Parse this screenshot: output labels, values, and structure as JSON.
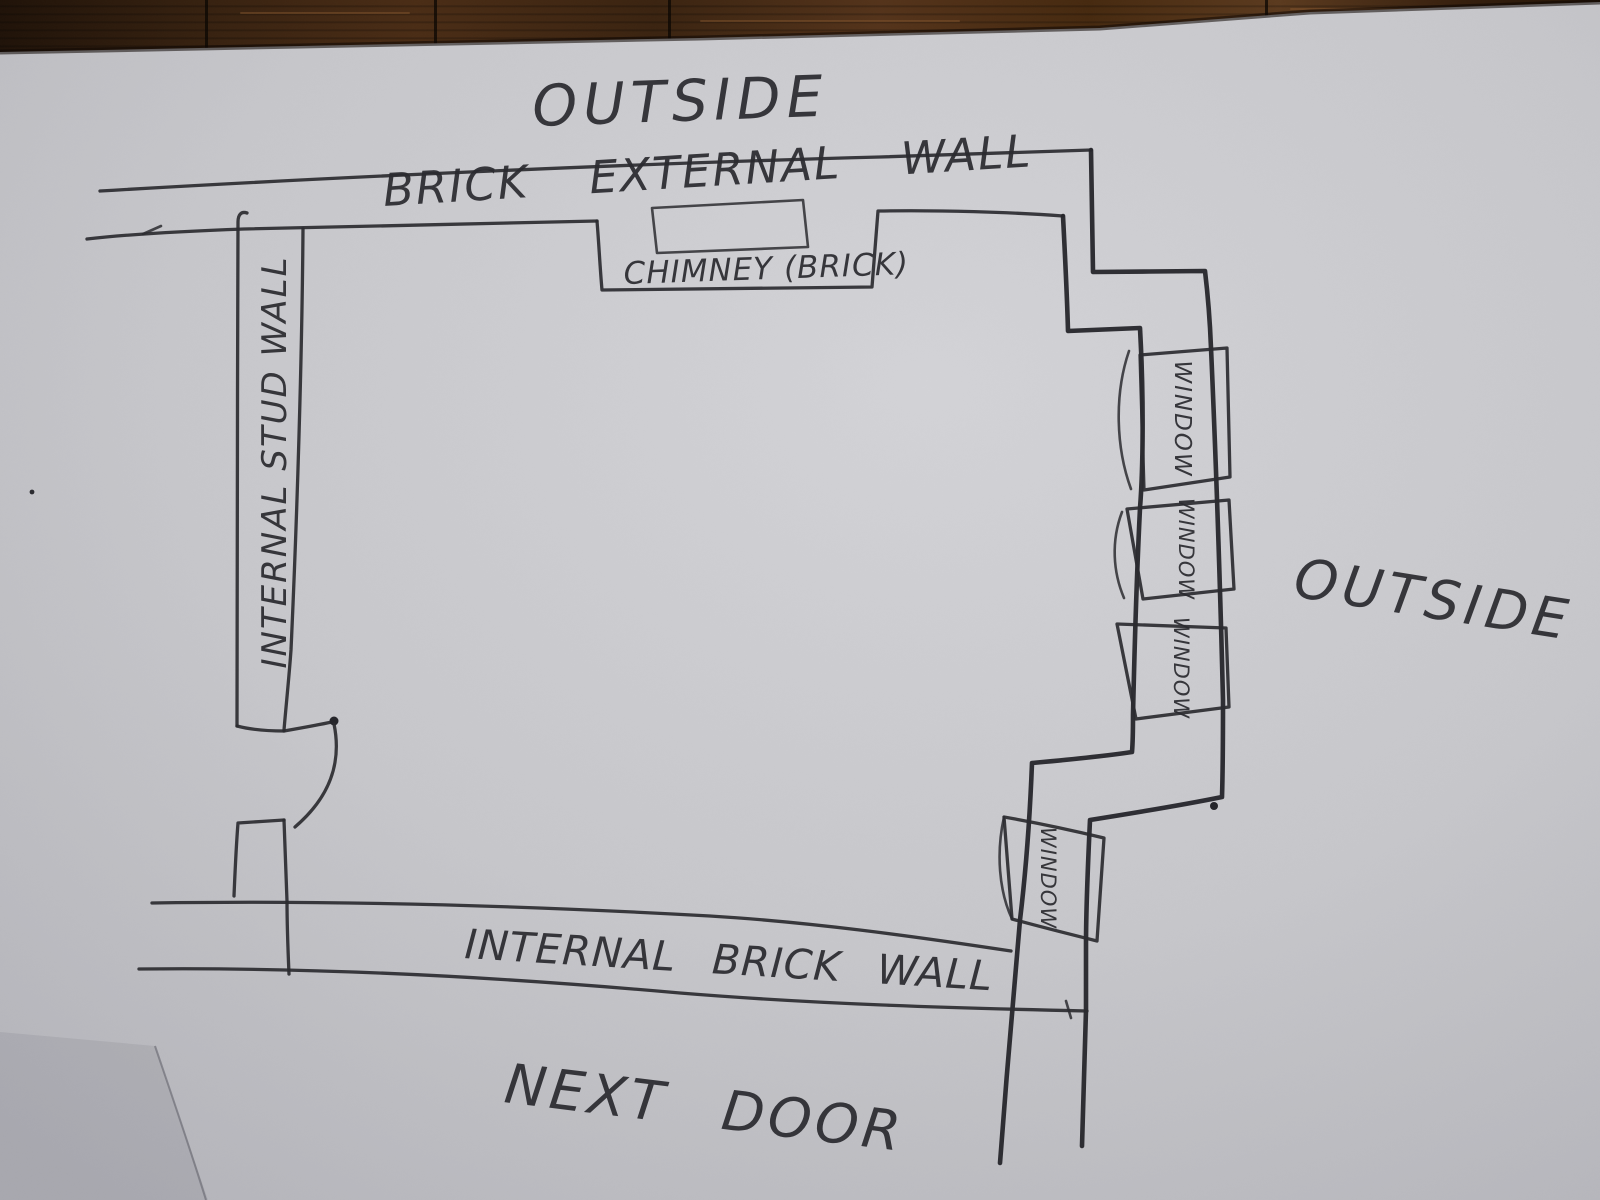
{
  "labels": {
    "outside_top": "OUTSIDE",
    "brick_external_wall": "BRICK EXTERNAL WALL",
    "chimney": "CHIMNEY (BRICK)",
    "internal_stud_wall": "INTERNAL STUD WALL",
    "outside_right": "OUTSIDE",
    "internal_brick_wall": "INTERNAL BRICK WALL",
    "next_door": "NEXT DOOR"
  },
  "windows": [
    {
      "label": "WINDOW"
    },
    {
      "label": "WINDOW"
    },
    {
      "label": "WINDOW"
    },
    {
      "label": "WINDOW"
    }
  ],
  "colors": {
    "ink": "#2b2b30",
    "paper": "#c7c7cb",
    "paper_highlight": "#d3d3d7",
    "paper_shadow": "#b4b4ba",
    "wood_dark": "#2a1910",
    "wood_light": "#5b3a1e"
  }
}
